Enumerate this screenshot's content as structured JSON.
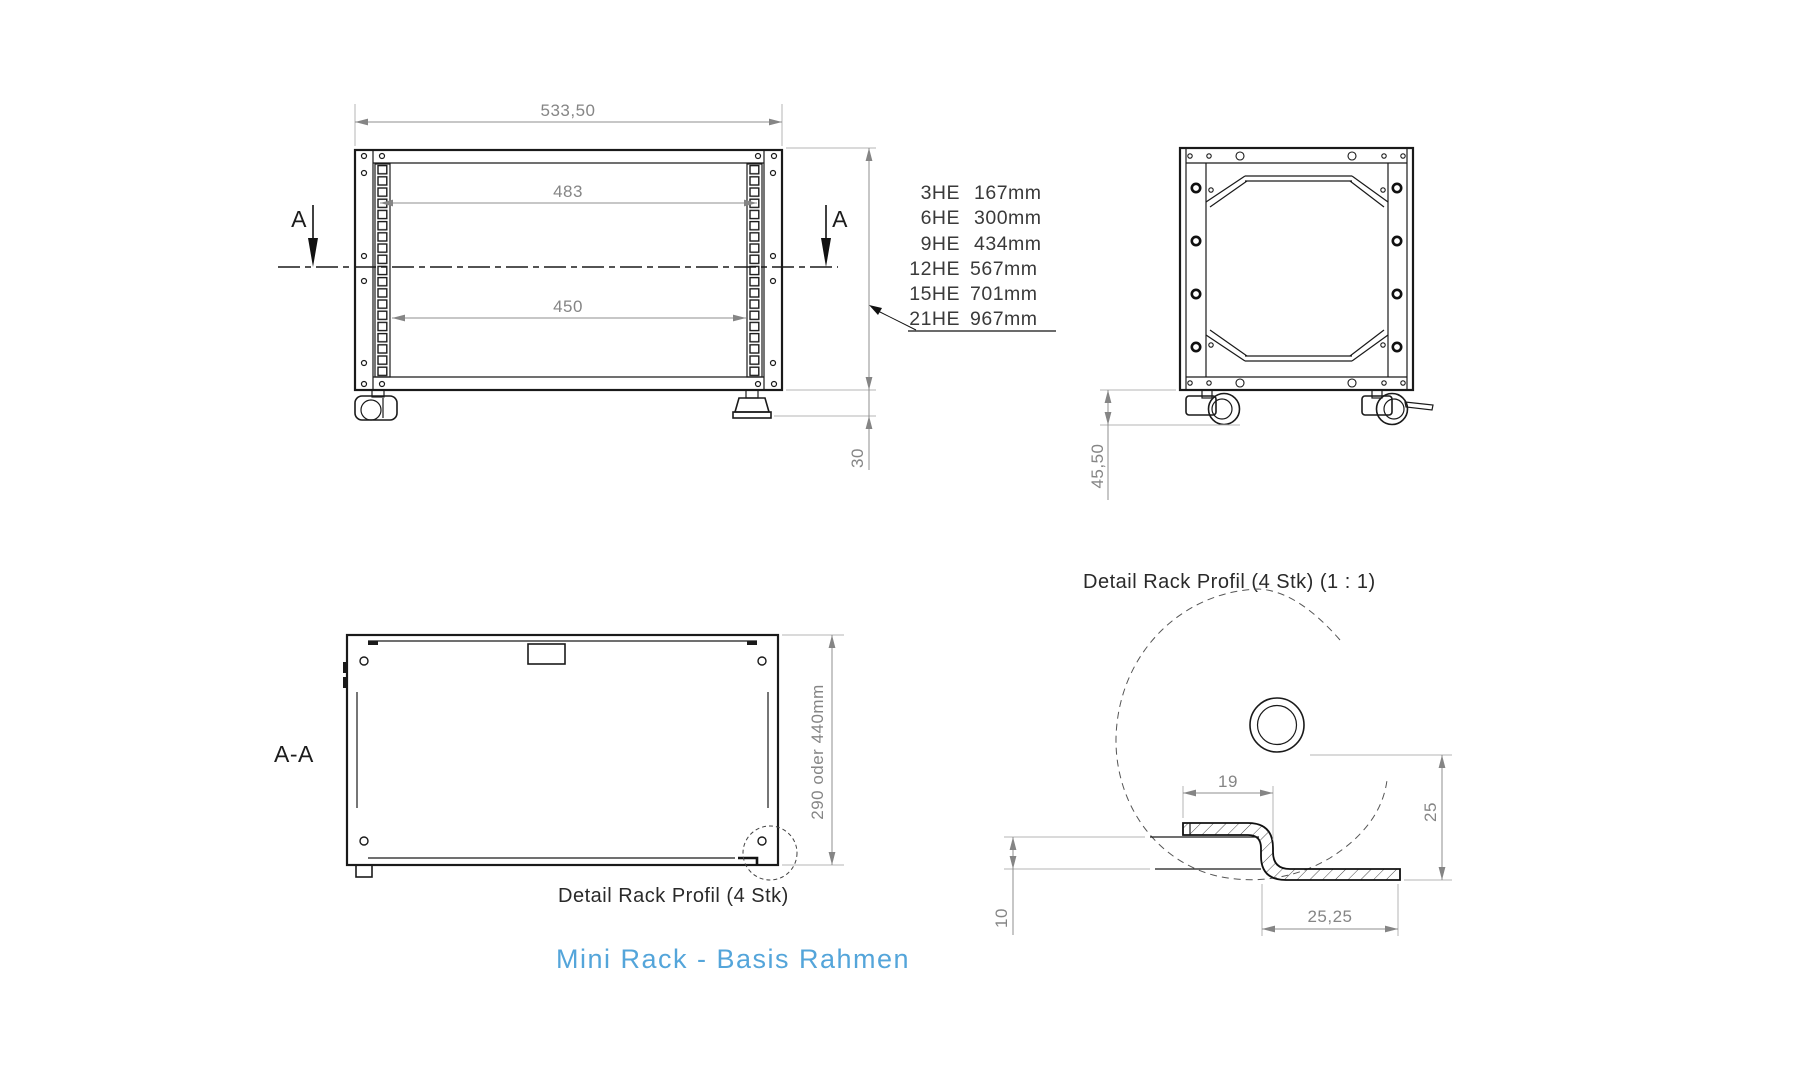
{
  "main_title": {
    "text": "Mini Rack  -  Basis Rahmen",
    "color": "#54a5da"
  },
  "front_view": {
    "dims": {
      "width_top": "533,50",
      "rail_hole_width": "483",
      "inner_width": "450",
      "foot_height": "30"
    },
    "section_marker_left": "A",
    "section_marker_right": "A",
    "he_table": [
      {
        "he": "3HE",
        "mm": "167mm"
      },
      {
        "he": "6HE",
        "mm": "300mm"
      },
      {
        "he": "9HE",
        "mm": "434mm"
      },
      {
        "he": "12HE",
        "mm": "567mm"
      },
      {
        "he": "15HE",
        "mm": "701mm"
      },
      {
        "he": "21HE",
        "mm": "967mm"
      }
    ]
  },
  "side_view": {
    "dims": {
      "caster_height": "45,50"
    }
  },
  "section_view": {
    "label": "A-A",
    "dims": {
      "height": "290  oder  440mm"
    },
    "callout": "Detail Rack Profil (4 Stk)"
  },
  "detail_view": {
    "title": "Detail Rack Profil (4 Stk) (1 : 1)",
    "dims": {
      "flange_width": "19",
      "panel_offset": "10",
      "profile_height": "25",
      "profile_depth": "25,25"
    }
  }
}
